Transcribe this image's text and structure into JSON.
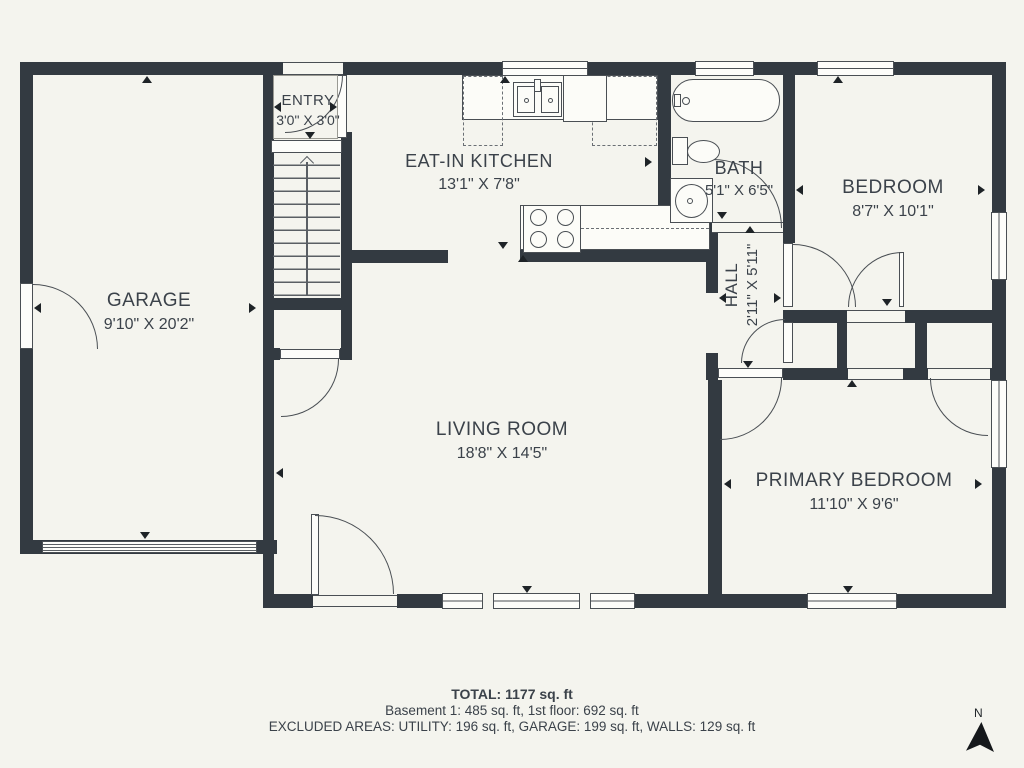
{
  "rooms": {
    "garage": {
      "name": "GARAGE",
      "dims": "9'10\" X 20'2\""
    },
    "entry": {
      "name": "ENTRY",
      "dims": "3'0\" X 3'0\""
    },
    "kitchen": {
      "name": "EAT-IN KITCHEN",
      "dims": "13'1\" X 7'8\""
    },
    "bath": {
      "name": "BATH",
      "dims": "5'1\" X 6'5\""
    },
    "bedroom": {
      "name": "BEDROOM",
      "dims": "8'7\" X 10'1\""
    },
    "hall": {
      "name": "HALL",
      "dims": "2'11\" X 5'11\""
    },
    "living": {
      "name": "LIVING ROOM",
      "dims": "18'8\" X 14'5\""
    },
    "primary": {
      "name": "PRIMARY BEDROOM",
      "dims": "11'10\" X 9'6\""
    }
  },
  "footer": {
    "total": "TOTAL: 1177 sq. ft",
    "line2": "Basement 1: 485 sq. ft, 1st floor: 692 sq. ft",
    "line3": "EXCLUDED AREAS: UTILITY: 196 sq. ft, GARAGE: 199 sq. ft, WALLS: 129 sq. ft"
  },
  "compass": {
    "label": "N"
  },
  "colors": {
    "wall": "#333a41",
    "background": "#f4f4ee",
    "line": "#4a4f54",
    "text": "#3b424a"
  }
}
